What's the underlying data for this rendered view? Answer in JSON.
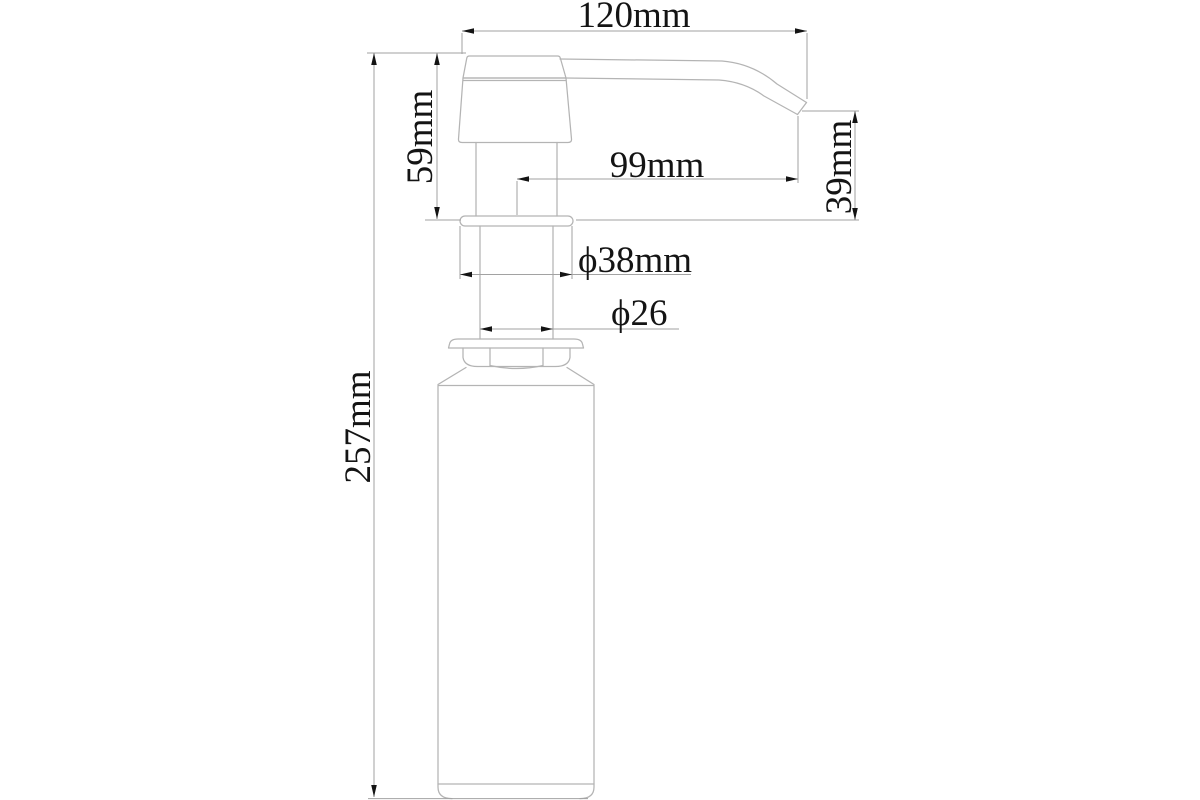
{
  "colors": {
    "background": "#ffffff",
    "part_line": "#b4b4b4",
    "dim_line": "#a2a2a2",
    "ink": "#141414"
  },
  "drawing": {
    "name": "soap-dispenser-pump-technical-drawing",
    "unit": "mm"
  },
  "dimensions": {
    "overall_width": {
      "label": "120mm",
      "value": 120,
      "unit": "mm",
      "orientation": "horizontal"
    },
    "head_height": {
      "label": "59mm",
      "value": 59,
      "unit": "mm",
      "orientation": "vertical"
    },
    "spout_reach": {
      "label": "99mm",
      "value": 99,
      "unit": "mm",
      "orientation": "horizontal"
    },
    "spout_drop": {
      "label": "39mm",
      "value": 39,
      "unit": "mm",
      "orientation": "vertical"
    },
    "flange_diameter": {
      "label": "ϕ38mm",
      "value": 38,
      "unit": "mm",
      "orientation": "horizontal"
    },
    "neck_diameter": {
      "label": "ϕ26",
      "value": 26,
      "unit": "mm",
      "orientation": "horizontal"
    },
    "overall_height": {
      "label": "257mm",
      "value": 257,
      "unit": "mm",
      "orientation": "vertical"
    }
  }
}
